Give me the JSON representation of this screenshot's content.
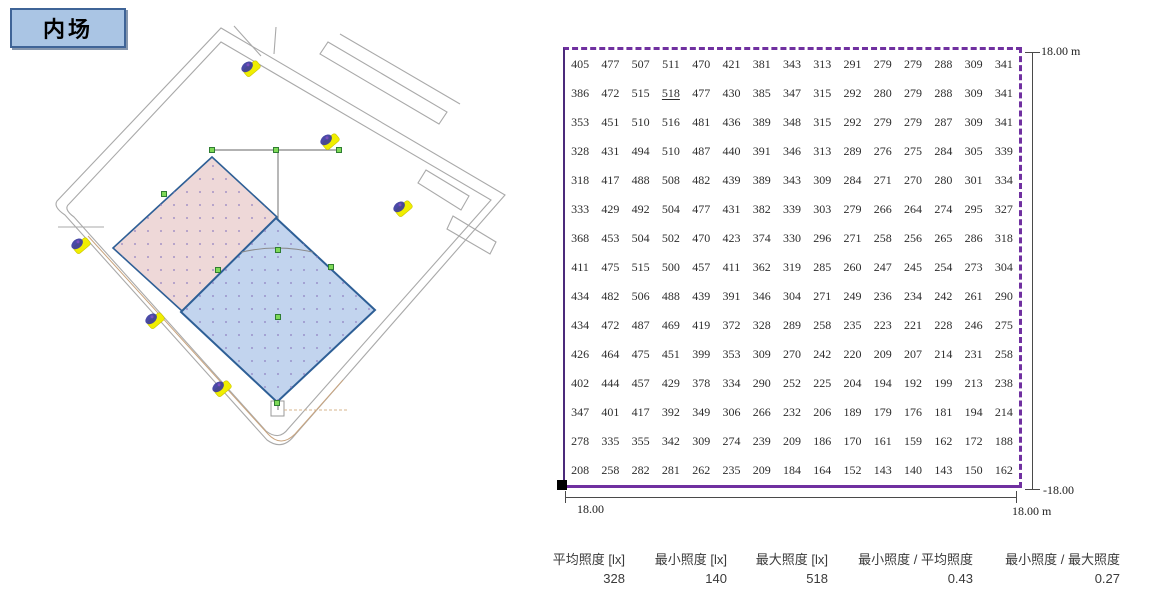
{
  "title_box": {
    "label": "内场"
  },
  "site_plan": {
    "pink_area_color": "#eed8d8",
    "blue_area_color": "#c2d4ee",
    "area_outline_color": "#2e5f96",
    "road_color": "#a9a9a9",
    "guide_line_color": "#999999",
    "tan_line_color": "#c9a47e",
    "luminaire_body_color": "#f0ee00",
    "luminaire_head_color": "#3b3b9e",
    "handle_color": "#7ed957"
  },
  "grid_panel": {
    "border_color": "#7030a0"
  },
  "dimensions": {
    "right_top": "18.00 m",
    "right_bottom": "-18.00",
    "bottom_left": "18.00",
    "bottom_right": "18.00 m"
  },
  "stats": [
    {
      "label": "平均照度 [lx]",
      "value": "328"
    },
    {
      "label": "最小照度 [lx]",
      "value": "140"
    },
    {
      "label": "最大照度 [lx]",
      "value": "518"
    },
    {
      "label": "最小照度 / 平均照度",
      "value": "0.43"
    },
    {
      "label": "最小照度 / 最大照度",
      "value": "0.27"
    }
  ],
  "chart_data": {
    "type": "heatmap",
    "unit": "lx",
    "rows": 15,
    "cols": 15,
    "x_extent": "18.00 m",
    "y_extent": "18.00 m",
    "values": [
      [
        405,
        477,
        507,
        511,
        470,
        421,
        381,
        343,
        313,
        291,
        279,
        279,
        288,
        309,
        341
      ],
      [
        386,
        472,
        515,
        518,
        477,
        430,
        385,
        347,
        315,
        292,
        280,
        279,
        288,
        309,
        341
      ],
      [
        353,
        451,
        510,
        516,
        481,
        436,
        389,
        348,
        315,
        292,
        279,
        279,
        287,
        309,
        341
      ],
      [
        328,
        431,
        494,
        510,
        487,
        440,
        391,
        346,
        313,
        289,
        276,
        275,
        284,
        305,
        339
      ],
      [
        318,
        417,
        488,
        508,
        482,
        439,
        389,
        343,
        309,
        284,
        271,
        270,
        280,
        301,
        334
      ],
      [
        333,
        429,
        492,
        504,
        477,
        431,
        382,
        339,
        303,
        279,
        266,
        264,
        274,
        295,
        327
      ],
      [
        368,
        453,
        504,
        502,
        470,
        423,
        374,
        330,
        296,
        271,
        258,
        256,
        265,
        286,
        318
      ],
      [
        411,
        475,
        515,
        500,
        457,
        411,
        362,
        319,
        285,
        260,
        247,
        245,
        254,
        273,
        304
      ],
      [
        434,
        482,
        506,
        488,
        439,
        391,
        346,
        304,
        271,
        249,
        236,
        234,
        242,
        261,
        290
      ],
      [
        434,
        472,
        487,
        469,
        419,
        372,
        328,
        289,
        258,
        235,
        223,
        221,
        228,
        246,
        275
      ],
      [
        426,
        464,
        475,
        451,
        399,
        353,
        309,
        270,
        242,
        220,
        209,
        207,
        214,
        231,
        258
      ],
      [
        402,
        444,
        457,
        429,
        378,
        334,
        290,
        252,
        225,
        204,
        194,
        192,
        199,
        213,
        238
      ],
      [
        347,
        401,
        417,
        392,
        349,
        306,
        266,
        232,
        206,
        189,
        179,
        176,
        181,
        194,
        214
      ],
      [
        278,
        335,
        355,
        342,
        309,
        274,
        239,
        209,
        186,
        170,
        161,
        159,
        162,
        172,
        188
      ],
      [
        208,
        258,
        282,
        281,
        262,
        235,
        209,
        184,
        164,
        152,
        143,
        140,
        143,
        150,
        162
      ]
    ],
    "max_value": 518,
    "min_value": 140,
    "avg_value": 328
  }
}
